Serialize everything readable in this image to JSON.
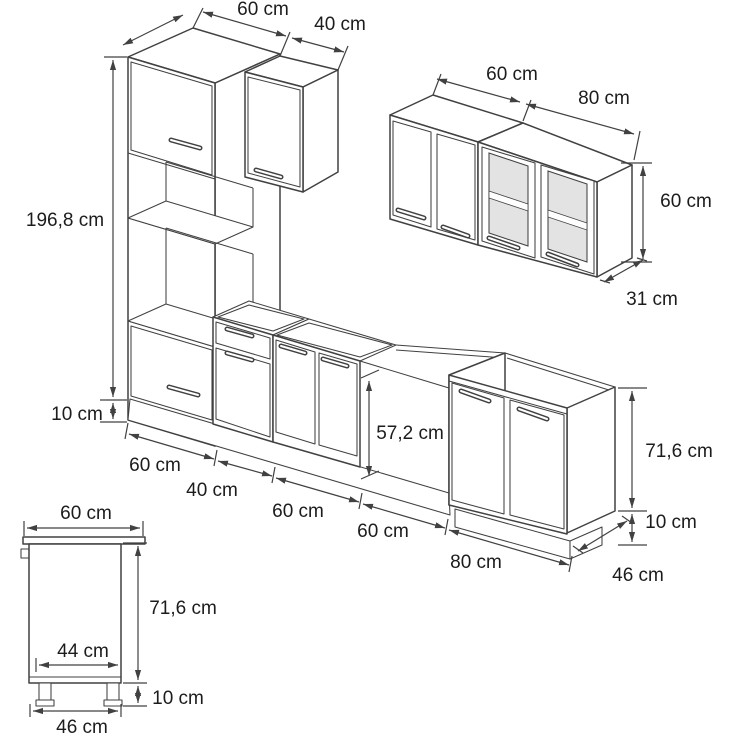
{
  "figure": {
    "type": "kitchen-cabinet-dimension-diagram",
    "background": "#ffffff",
    "line_color": "#414141",
    "text_color": "#1c1c1c",
    "glass_fill": "#e3e3e3"
  },
  "tall_unit": {
    "width": "60 cm",
    "height": "196,8 cm",
    "plinth": "10 cm"
  },
  "wall_unit_small": {
    "width": "40 cm"
  },
  "wall_units": {
    "width_left": "60 cm",
    "width_right": "80 cm",
    "height": "60 cm",
    "depth": "31 cm"
  },
  "base_units": {
    "widths": [
      "60 cm",
      "40 cm",
      "60 cm",
      "60 cm",
      "80 cm"
    ],
    "appliance_niche_height": "57,2 cm",
    "carcass_height": "71,6 cm",
    "plinth_height": "10 cm",
    "depth": "46 cm"
  },
  "side_view": {
    "worktop_depth": "60 cm",
    "carcass_height": "71,6 cm",
    "inner_depth": "44 cm",
    "plinth_height": "10 cm",
    "carcass_depth": "46 cm"
  }
}
